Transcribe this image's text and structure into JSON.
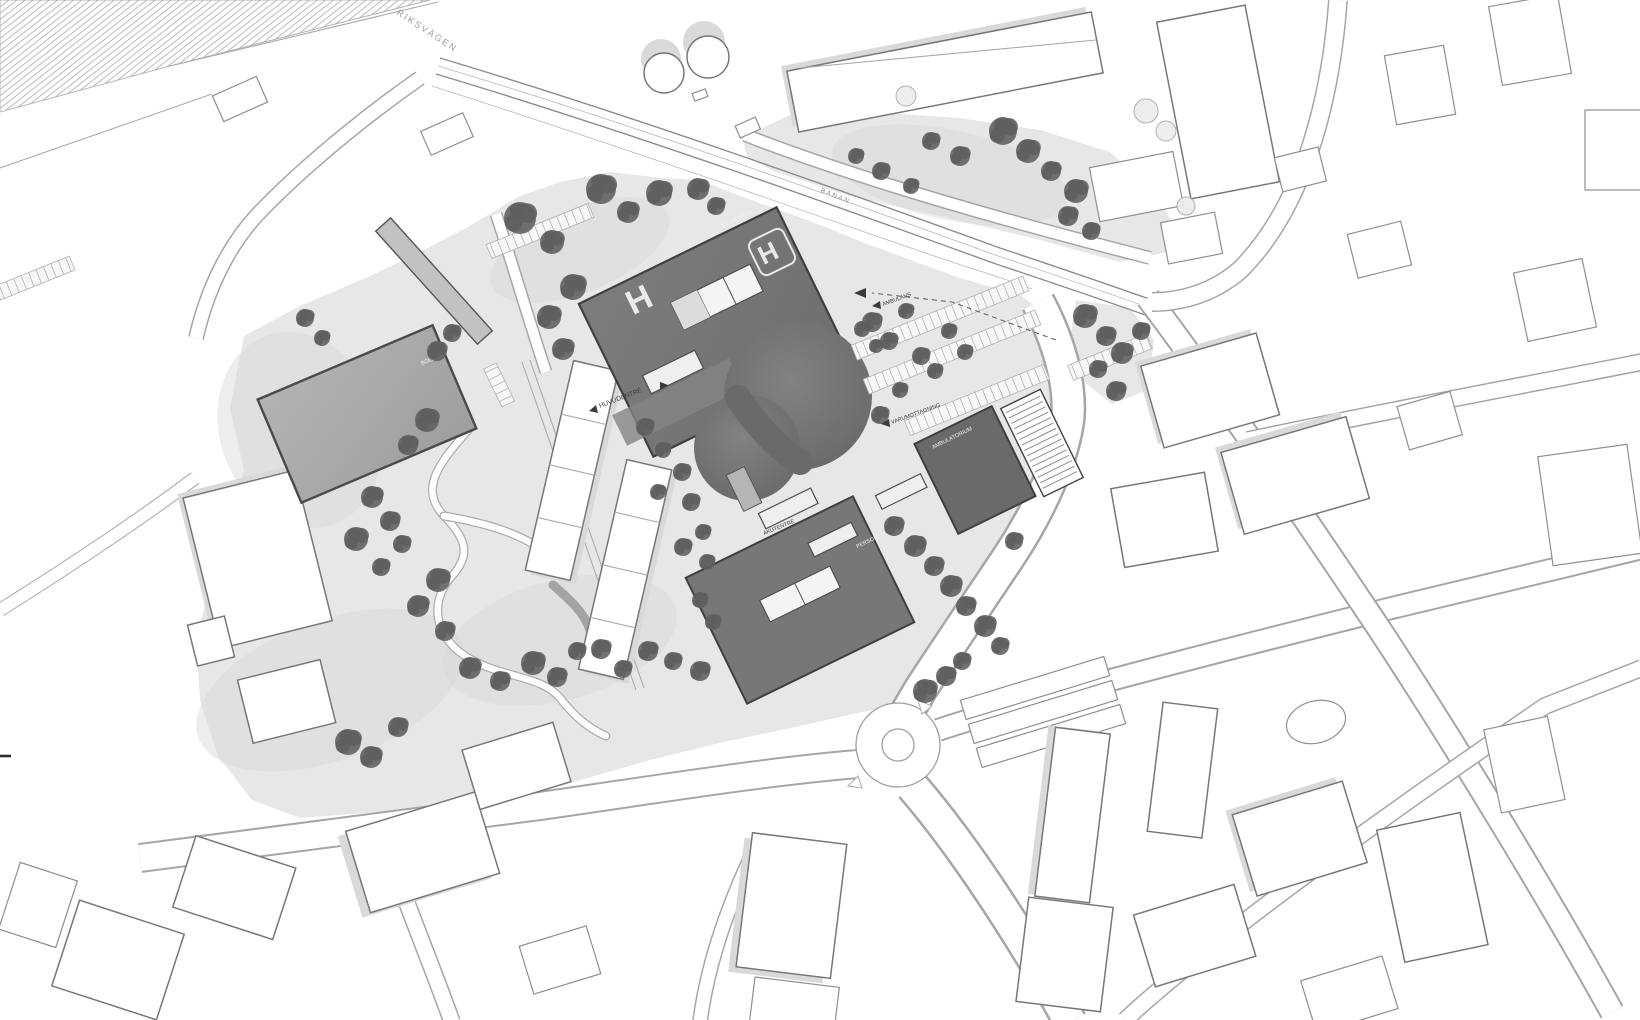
{
  "drawing": {
    "kind": "hospital campus site plan",
    "style": "grayscale architectural master plan"
  },
  "colors": {
    "ground": "#e7e7e7",
    "ground_shade": "#d8d8d8",
    "campus_building": "#777777",
    "campus_building_dark": "#6a6a6a",
    "building_outline": "#3f3f3f",
    "context_outline": "#8f8f8f",
    "context_fill": "#ffffff",
    "shadow": "#d9d9d9",
    "tree_dark": "#5e5e5e",
    "tree_mid": "#707070",
    "road_edge": "#a6a6a6",
    "rail_dark": "#9a9a9a",
    "label_dark": "#3a3a3a",
    "label_light": "#f2f2f2"
  },
  "labels": {
    "road_top": "RIKSVÄGEN",
    "railway": "BANAN",
    "hospital_roof": "SJUKHUS",
    "helipad": "H",
    "main_entrance": "HUVUDENTRÉ",
    "emergency_entrance": "AKUTENTRÉ",
    "goods_delivery": "VARUMOTTAGNING",
    "ambulance": "AMBULANS",
    "outpatient_building": "AMBULATORIUM",
    "staff_entrance": "PERSONALENTRÉ",
    "sports_field": "BOLLPLAN"
  }
}
